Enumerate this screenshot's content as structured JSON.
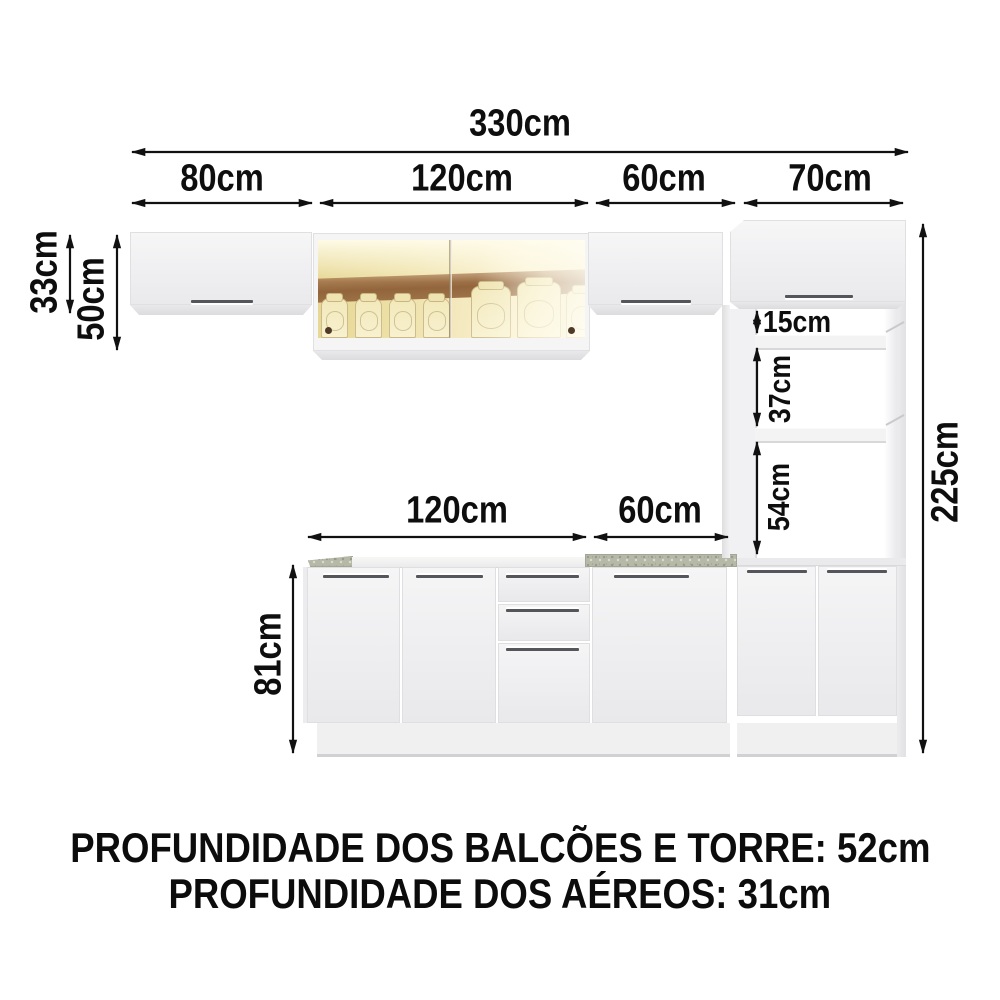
{
  "dimensions": {
    "total_width": "330cm",
    "top_segments": [
      "80cm",
      "120cm",
      "60cm",
      "70cm"
    ],
    "wall_cabinet_height": "33cm",
    "glass_cabinet_height": "50cm",
    "tower_height": "225cm",
    "tower_gaps": [
      "15cm",
      "37cm",
      "54cm"
    ],
    "base_segments": [
      "120cm",
      "60cm"
    ],
    "base_height": "81cm"
  },
  "footer": {
    "line1": "PROFUNDIDADE DOS BALCÕES E TORRE: 52cm",
    "line2": "PROFUNDIDADE DOS AÉREOS: 31cm"
  },
  "colors": {
    "cabinet_face": "#f2f2f3",
    "glass_amber": "#eee0a8",
    "interior_band_brown": "#8a5a33",
    "granite_counter": "#b6b9a8",
    "dimension_ink": "#111111"
  }
}
